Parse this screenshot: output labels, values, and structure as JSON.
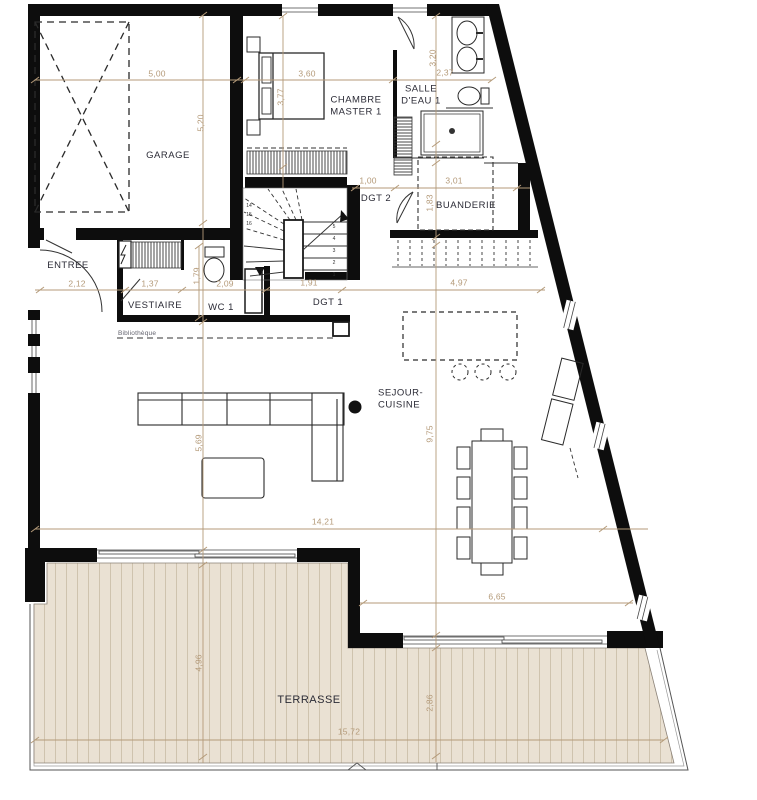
{
  "colors": {
    "wall": "#0d0d0d",
    "dimension": "#b49a79",
    "room_label": "#2b2b36",
    "terrace_fill": "#eae1d3",
    "terrace_plank": "#cfc3ae"
  },
  "plan": {
    "rooms": [
      {
        "name": "room-label-garage",
        "label": "GARAGE",
        "x": 168,
        "y": 156
      },
      {
        "name": "room-label-chambre-master-1",
        "label": "CHAMBRE\nMASTER 1",
        "x": 356,
        "y": 107
      },
      {
        "name": "room-label-salle-deau-1",
        "label": "SALLE\nD'EAU 1",
        "x": 421,
        "y": 96
      },
      {
        "name": "room-label-entree",
        "label": "ENTREE",
        "x": 68,
        "y": 266
      },
      {
        "name": "room-label-vestiaire",
        "label": "VESTIAIRE",
        "x": 155,
        "y": 306
      },
      {
        "name": "room-label-wc-1",
        "label": "WC 1",
        "x": 221,
        "y": 308
      },
      {
        "name": "room-label-dgt-1",
        "label": "DGT 1",
        "x": 328,
        "y": 303
      },
      {
        "name": "room-label-dgt-2",
        "label": "DGT 2",
        "x": 376,
        "y": 199
      },
      {
        "name": "room-label-buanderie",
        "label": "BUANDERIE",
        "x": 466,
        "y": 206
      },
      {
        "name": "room-label-sejour-cuisine",
        "label": "SEJOUR-\nCUISINE",
        "x": 378,
        "y": 400,
        "align": "left"
      },
      {
        "name": "room-label-terrasse",
        "label": "TERRASSE",
        "x": 309,
        "y": 700,
        "size": 11
      }
    ],
    "dimensions": [
      {
        "text": "5,00",
        "x": 157,
        "y": 74
      },
      {
        "text": "3,60",
        "x": 307,
        "y": 74
      },
      {
        "text": "2,37",
        "x": 445,
        "y": 73
      },
      {
        "text": "1,00",
        "x": 368,
        "y": 181
      },
      {
        "text": "3,01",
        "x": 454,
        "y": 181
      },
      {
        "text": "2,12",
        "x": 77,
        "y": 284
      },
      {
        "text": "1,37",
        "x": 150,
        "y": 284
      },
      {
        "text": "2,09",
        "x": 225,
        "y": 284
      },
      {
        "text": "1,91",
        "x": 309,
        "y": 283
      },
      {
        "text": "4,97",
        "x": 459,
        "y": 283
      },
      {
        "text": "14,21",
        "x": 323,
        "y": 522
      },
      {
        "text": "6,65",
        "x": 497,
        "y": 597
      },
      {
        "text": "15,72",
        "x": 349,
        "y": 732
      },
      {
        "text": "5,20",
        "x": 201,
        "y": 123,
        "rot": true
      },
      {
        "text": "3,77",
        "x": 281,
        "y": 97,
        "rot": true
      },
      {
        "text": "3,20",
        "x": 433,
        "y": 58,
        "rot": true
      },
      {
        "text": "1,83",
        "x": 430,
        "y": 203,
        "rot": true
      },
      {
        "text": "1,79",
        "x": 197,
        "y": 276,
        "rot": true
      },
      {
        "text": "9,75",
        "x": 430,
        "y": 434,
        "rot": true
      },
      {
        "text": "5,69",
        "x": 199,
        "y": 443,
        "rot": true
      },
      {
        "text": "4,96",
        "x": 199,
        "y": 663,
        "rot": true
      },
      {
        "text": "2,86",
        "x": 430,
        "y": 703,
        "rot": true
      }
    ],
    "stair_numbers": [
      {
        "text": "1",
        "x": 334,
        "y": 275
      },
      {
        "text": "2",
        "x": 334,
        "y": 263
      },
      {
        "text": "3",
        "x": 334,
        "y": 251
      },
      {
        "text": "4",
        "x": 334,
        "y": 239
      },
      {
        "text": "5",
        "x": 334,
        "y": 227
      },
      {
        "text": "14",
        "x": 249,
        "y": 206
      },
      {
        "text": "15",
        "x": 249,
        "y": 215
      },
      {
        "text": "16",
        "x": 249,
        "y": 224
      }
    ],
    "annotations": [
      {
        "name": "annotation-bibliotheque",
        "label": "Bibliothèque",
        "x": 118,
        "y": 334,
        "align": "left"
      }
    ]
  }
}
